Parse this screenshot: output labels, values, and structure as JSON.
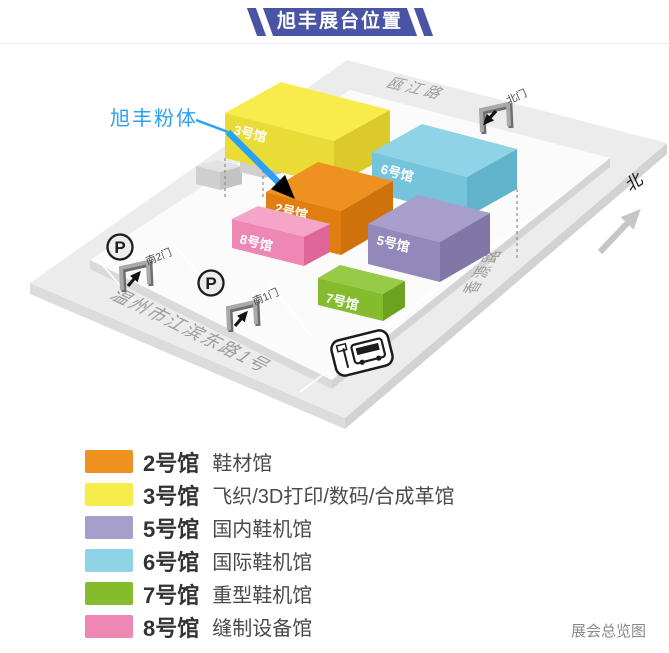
{
  "title": "旭丰展台位置",
  "theme": {
    "ribbon_color": "#4A54A4",
    "callout_color": "#2AA1F4"
  },
  "map": {
    "callout_label": "旭丰粉体",
    "north_label": "北",
    "roads": {
      "top": "瓯江路",
      "right": "香源路",
      "bottom": "温州市江滨东路1号"
    },
    "gates": {
      "north": "北门",
      "south_2": "南2门",
      "south_1": "南1门"
    },
    "parking_label": "P"
  },
  "halls": [
    {
      "label": "2号馆",
      "desc": "鞋材馆",
      "color": "#EF9120"
    },
    {
      "label": "3号馆",
      "desc": "飞织/3D打印/数码/合成革馆",
      "color": "#F7EC4B"
    },
    {
      "label": "5号馆",
      "desc": "国内鞋机馆",
      "color": "#A89ECB"
    },
    {
      "label": "6号馆",
      "desc": "国际鞋机馆",
      "color": "#8FD3E6"
    },
    {
      "label": "7号馆",
      "desc": "重型鞋机馆",
      "color": "#84BC2D"
    },
    {
      "label": "8号馆",
      "desc": "缝制设备馆",
      "color": "#EF87B5"
    }
  ],
  "footer": "展会总览图"
}
